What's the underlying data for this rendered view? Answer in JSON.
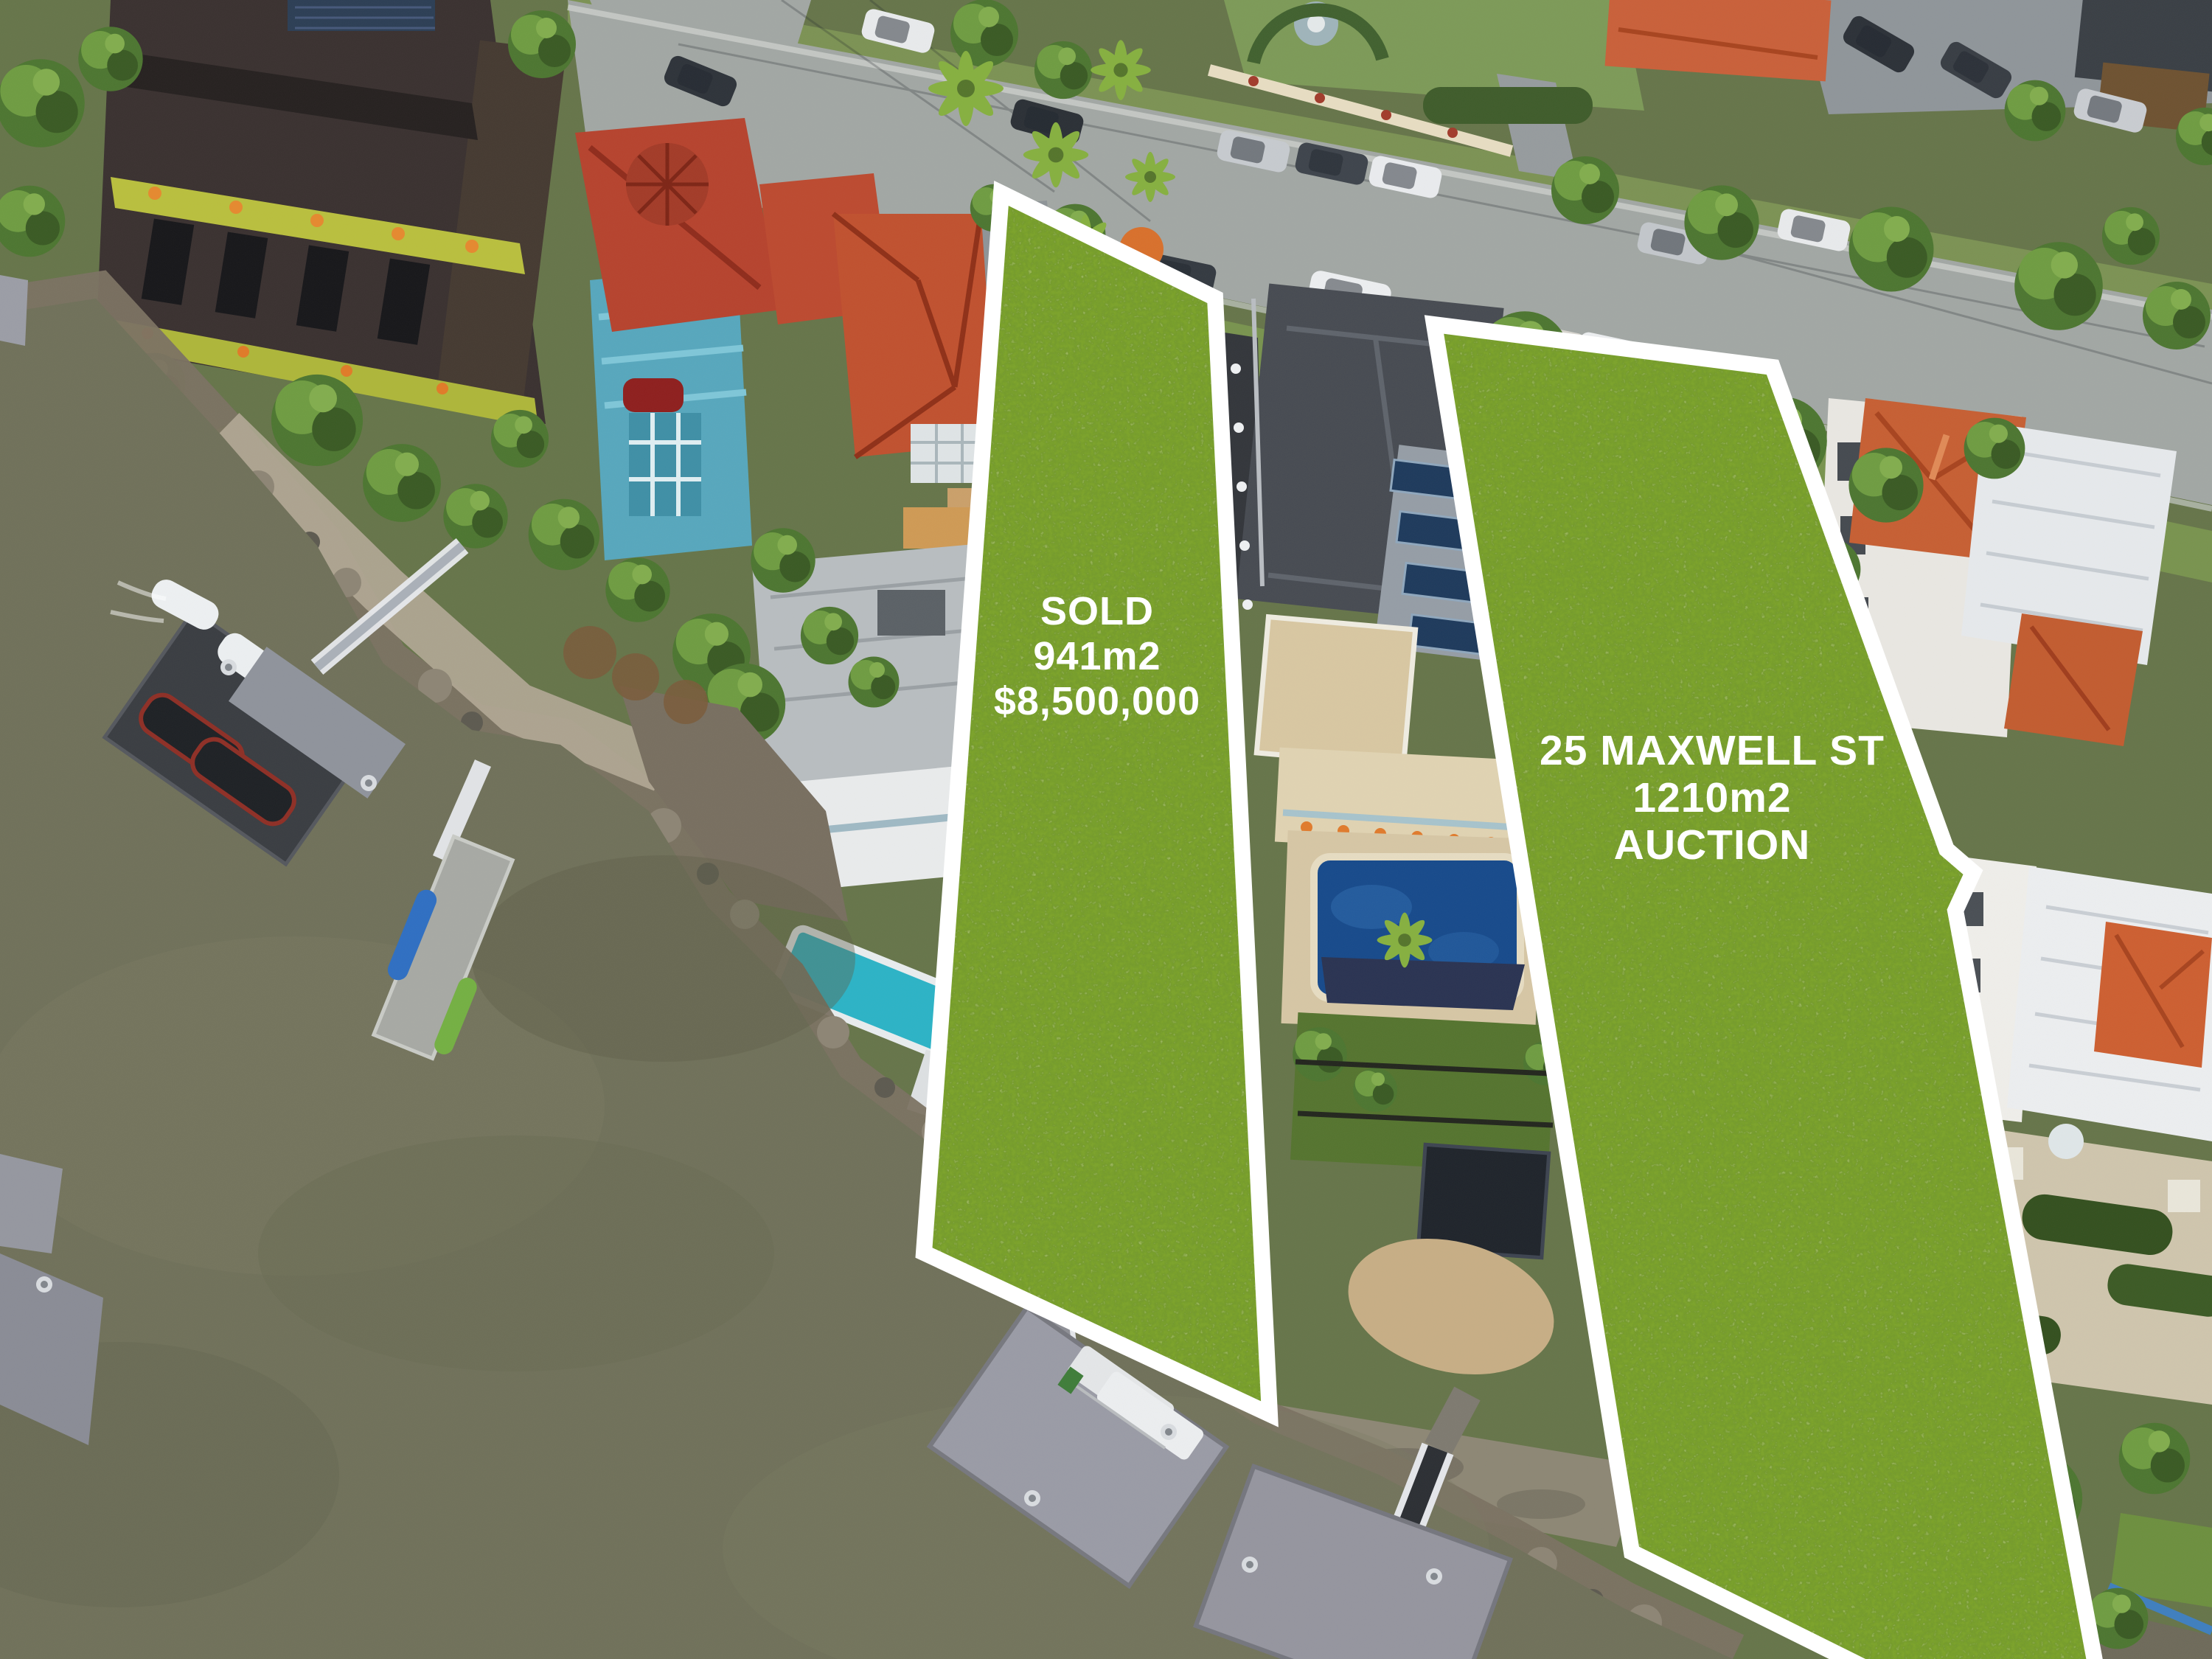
{
  "overlays": {
    "sold_lot": {
      "status": "SOLD",
      "area": "941m2",
      "price": "$8,500,000"
    },
    "auction_lot": {
      "address": "25 MAXWELL ST",
      "area": "1210m2",
      "method": "AUCTION"
    }
  },
  "colors": {
    "lot_fill": "#7da32d",
    "lot_border": "#ffffff",
    "label_text": "#ffffff",
    "water": "#70715a",
    "street": "#a2a7a4",
    "terracotta_roof": "#c65f33"
  }
}
